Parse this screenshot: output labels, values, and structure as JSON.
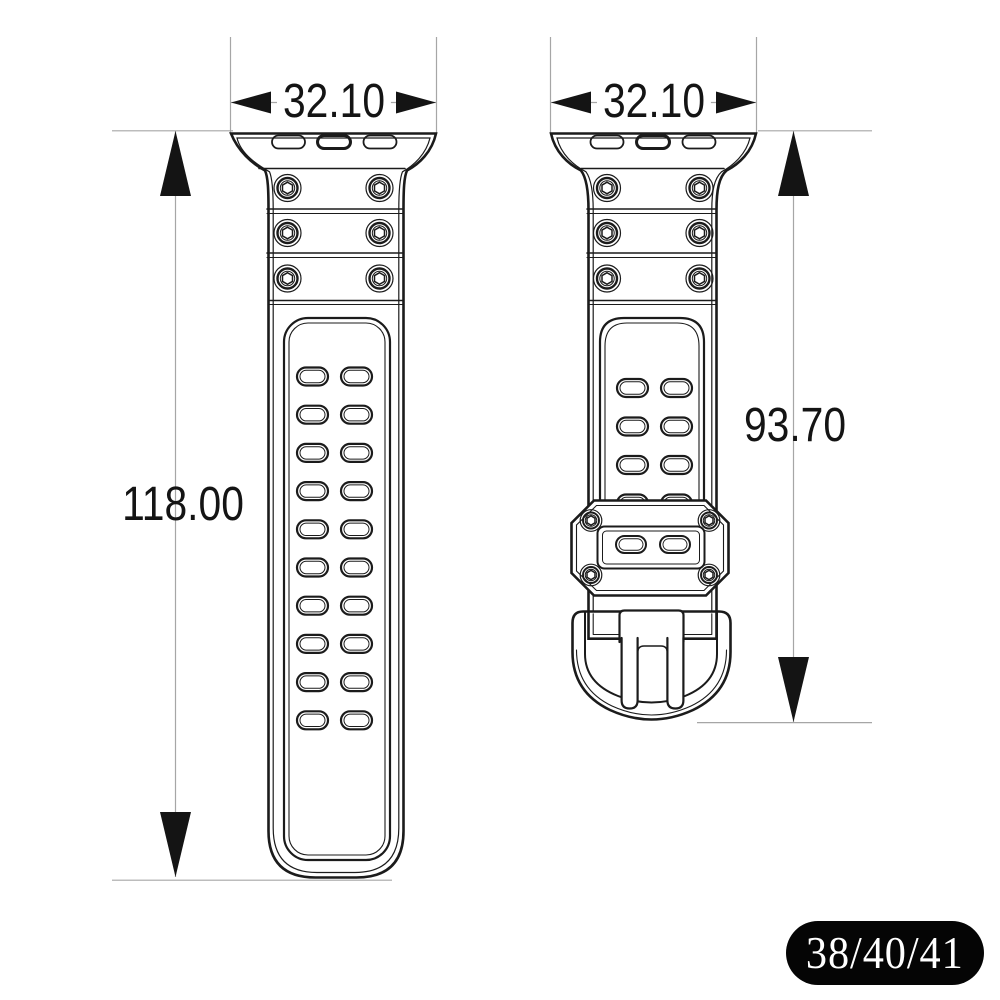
{
  "drawing": {
    "title": "watch band dimension drawing",
    "views": {
      "front": {
        "adapter_slots": 3,
        "screw_rows": 3,
        "screw_cols": 2,
        "hole_rows": 10,
        "hole_cols": 2
      },
      "buckle": {
        "adapter_slots": 3,
        "screw_rows": 3,
        "screw_cols": 2,
        "hole_rows": 4,
        "hole_cols": 2,
        "keeper_screws": 4,
        "keeper_slots": 2
      }
    }
  },
  "dimensions": {
    "front_width_mm": "32.10",
    "buckle_width_mm": "32.10",
    "front_length_mm": "118.00",
    "buckle_length_mm": "93.70"
  },
  "badge": {
    "label": "38/40/41"
  },
  "colors": {
    "background": "#ffffff",
    "line": "#1b1b1b",
    "dimension_line": "#a6a6a6",
    "badge_background": "#050505",
    "badge_text": "#ffffff"
  }
}
